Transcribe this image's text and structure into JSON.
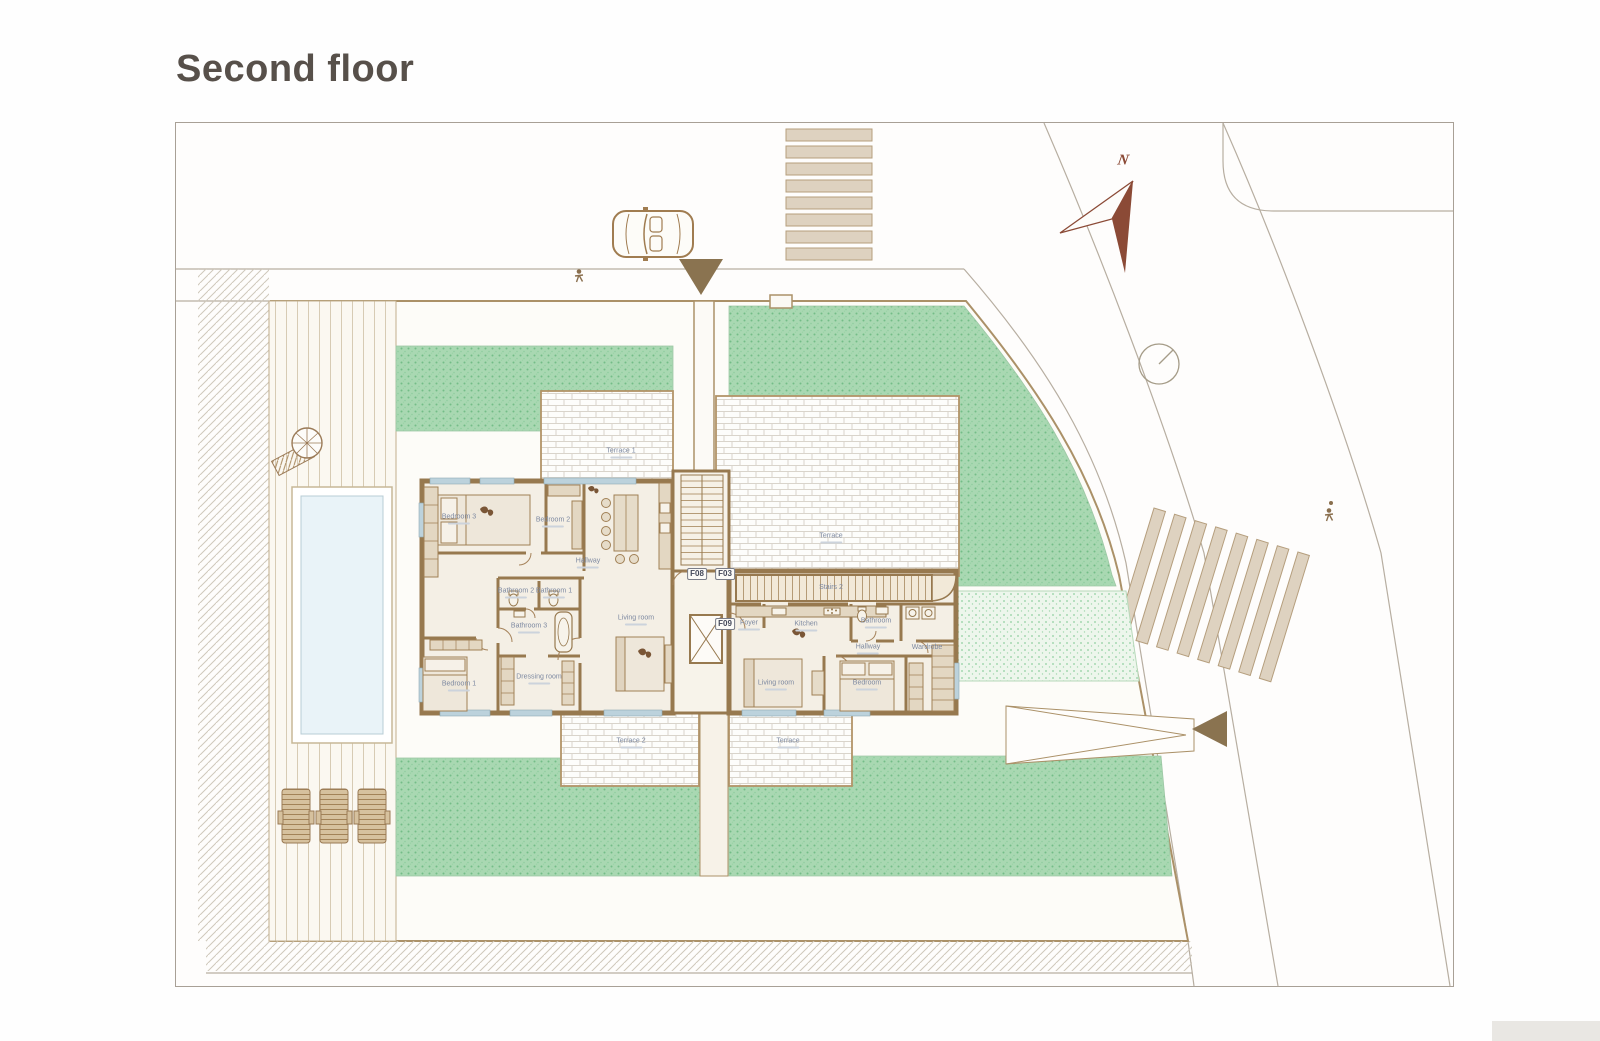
{
  "page_title": "Second floor",
  "compass": {
    "north_label": "N"
  },
  "unit_tags": [
    {
      "label": "F08"
    },
    {
      "label": "F03"
    },
    {
      "label": "F09"
    }
  ],
  "rooms_left": [
    {
      "name": "Bedroom 3"
    },
    {
      "name": "Bedroom 2"
    },
    {
      "name": "Hallway"
    },
    {
      "name": "Bathroom 2"
    },
    {
      "name": "Bathroom 1"
    },
    {
      "name": "Bathroom 3"
    },
    {
      "name": "Dressing room"
    },
    {
      "name": "Bedroom 1"
    },
    {
      "name": "Living room"
    },
    {
      "name": "Terrace 1"
    },
    {
      "name": "Terrace 2"
    }
  ],
  "rooms_right": [
    {
      "name": "Foyer"
    },
    {
      "name": "Kitchen"
    },
    {
      "name": "Stairs 2"
    },
    {
      "name": "Bathroom"
    },
    {
      "name": "Hallway"
    },
    {
      "name": "Living room"
    },
    {
      "name": "Bedroom"
    },
    {
      "name": "Wardrobe"
    },
    {
      "name": "Terrace"
    },
    {
      "name": "Terrace"
    }
  ],
  "legend_colors": {
    "wall": "#97794f",
    "garden_green": "#a9d8b2",
    "pool_water": "#e9f3f8",
    "compass_rust": "#8b4a36",
    "crosswalk_stripe": "#ded2c0",
    "deck_line": "#d7cbb4"
  }
}
